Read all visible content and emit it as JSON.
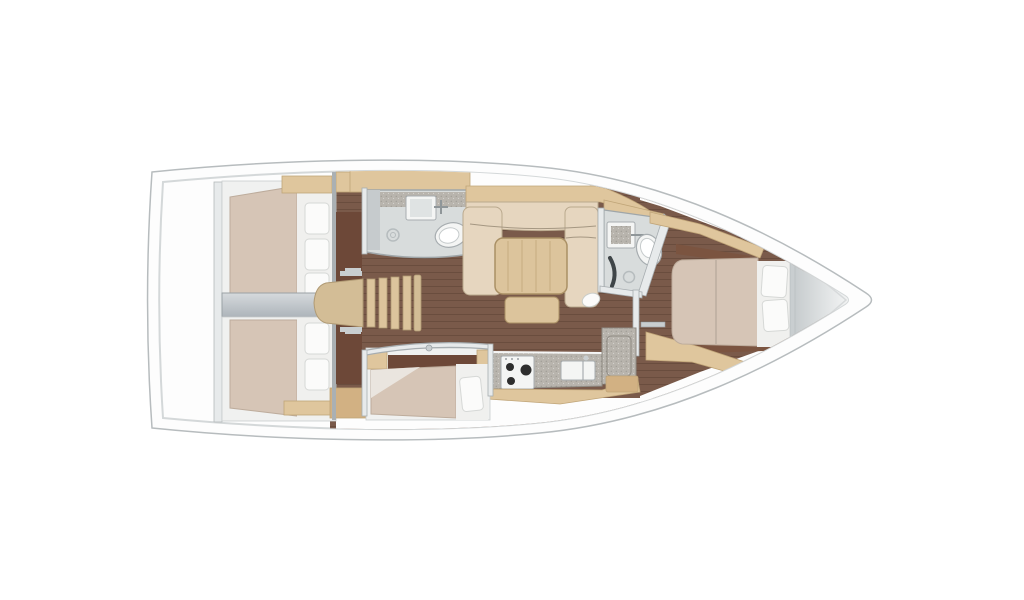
{
  "figure": {
    "type": "yacht-interior-floor-plan",
    "view": "top-down",
    "bow_direction": "right"
  },
  "inventory": {
    "rooms": [
      {
        "id": "aft-cabin-port",
        "kind": "double-berth-cabin",
        "pillows": 3
      },
      {
        "id": "aft-cabin-starboard",
        "kind": "double-berth-cabin",
        "pillows": 2
      },
      {
        "id": "companionway",
        "kind": "stairs-with-rungs"
      },
      {
        "id": "head-midship",
        "kind": "bathroom",
        "fixtures": [
          "sink",
          "toilet",
          "shower-drain"
        ]
      },
      {
        "id": "salon",
        "kind": "saloon",
        "furniture": [
          "sofa",
          "chaise",
          "table",
          "bench",
          "stool"
        ]
      },
      {
        "id": "bunk-cabin",
        "kind": "single-berth-cabin",
        "pillows": 1
      },
      {
        "id": "galley",
        "kind": "galley",
        "fixtures": [
          "stove-3-burner",
          "sink",
          "counter",
          "icebox"
        ]
      },
      {
        "id": "head-forward",
        "kind": "bathroom",
        "fixtures": [
          "sink",
          "toilet",
          "shower-drain"
        ]
      },
      {
        "id": "forward-cabin",
        "kind": "double-berth-cabin",
        "pillows": 2
      },
      {
        "id": "bow-locker",
        "kind": "anchor-locker"
      }
    ]
  },
  "colors": {
    "hull_white": "#fdfdfd",
    "outline_gray": "#b7bcbe",
    "deck_line": "#d4d8d9",
    "floor_brown": "#7a5a4a",
    "plank_line": "rgba(52,30,20,0.22)",
    "cabin_floor_dark": "#6d4838",
    "fwd_shelf_brown": "#7b5440",
    "mattress_beige": "#d6c5b6",
    "mattress_stroke": "#bdac9c",
    "linen_white": "#f0f0ee",
    "pillow_white": "#fbfbfa",
    "pillow_stroke": "#d6d8d6",
    "wood_light": "#dfc69d",
    "wood_mid": "#d2b183",
    "wood_stroke": "#c0a578",
    "stair_wood": "#d3bd96",
    "stair_stroke": "#b09a74",
    "table_wood": "#dcc49c",
    "table_stroke": "#aa9065",
    "sofa_beige": "#e6d6bf",
    "sofa_stroke": "#baa98e",
    "tile_gray": "#d8dcdc",
    "tile_stroke": "#9fa6a9",
    "counter_gray": "#b8b4ad",
    "counter_stroke": "#8f8b84",
    "corridor_light": "#d6dadd",
    "corridor_dark": "#adb4ba",
    "wall_gray": "#aab0b3",
    "wall_white": "#e7eaeb",
    "fixture_white": "#f4f5f4",
    "fixture_stroke": "#a7adb0",
    "metal_gray": "#c9ced0",
    "burner_black": "#2e2e2e",
    "bow_light": "#f6f7f7",
    "bow_dark": "#c7ccce",
    "base_white": "#f0f1f0",
    "dark_accent": "#3f4548"
  }
}
